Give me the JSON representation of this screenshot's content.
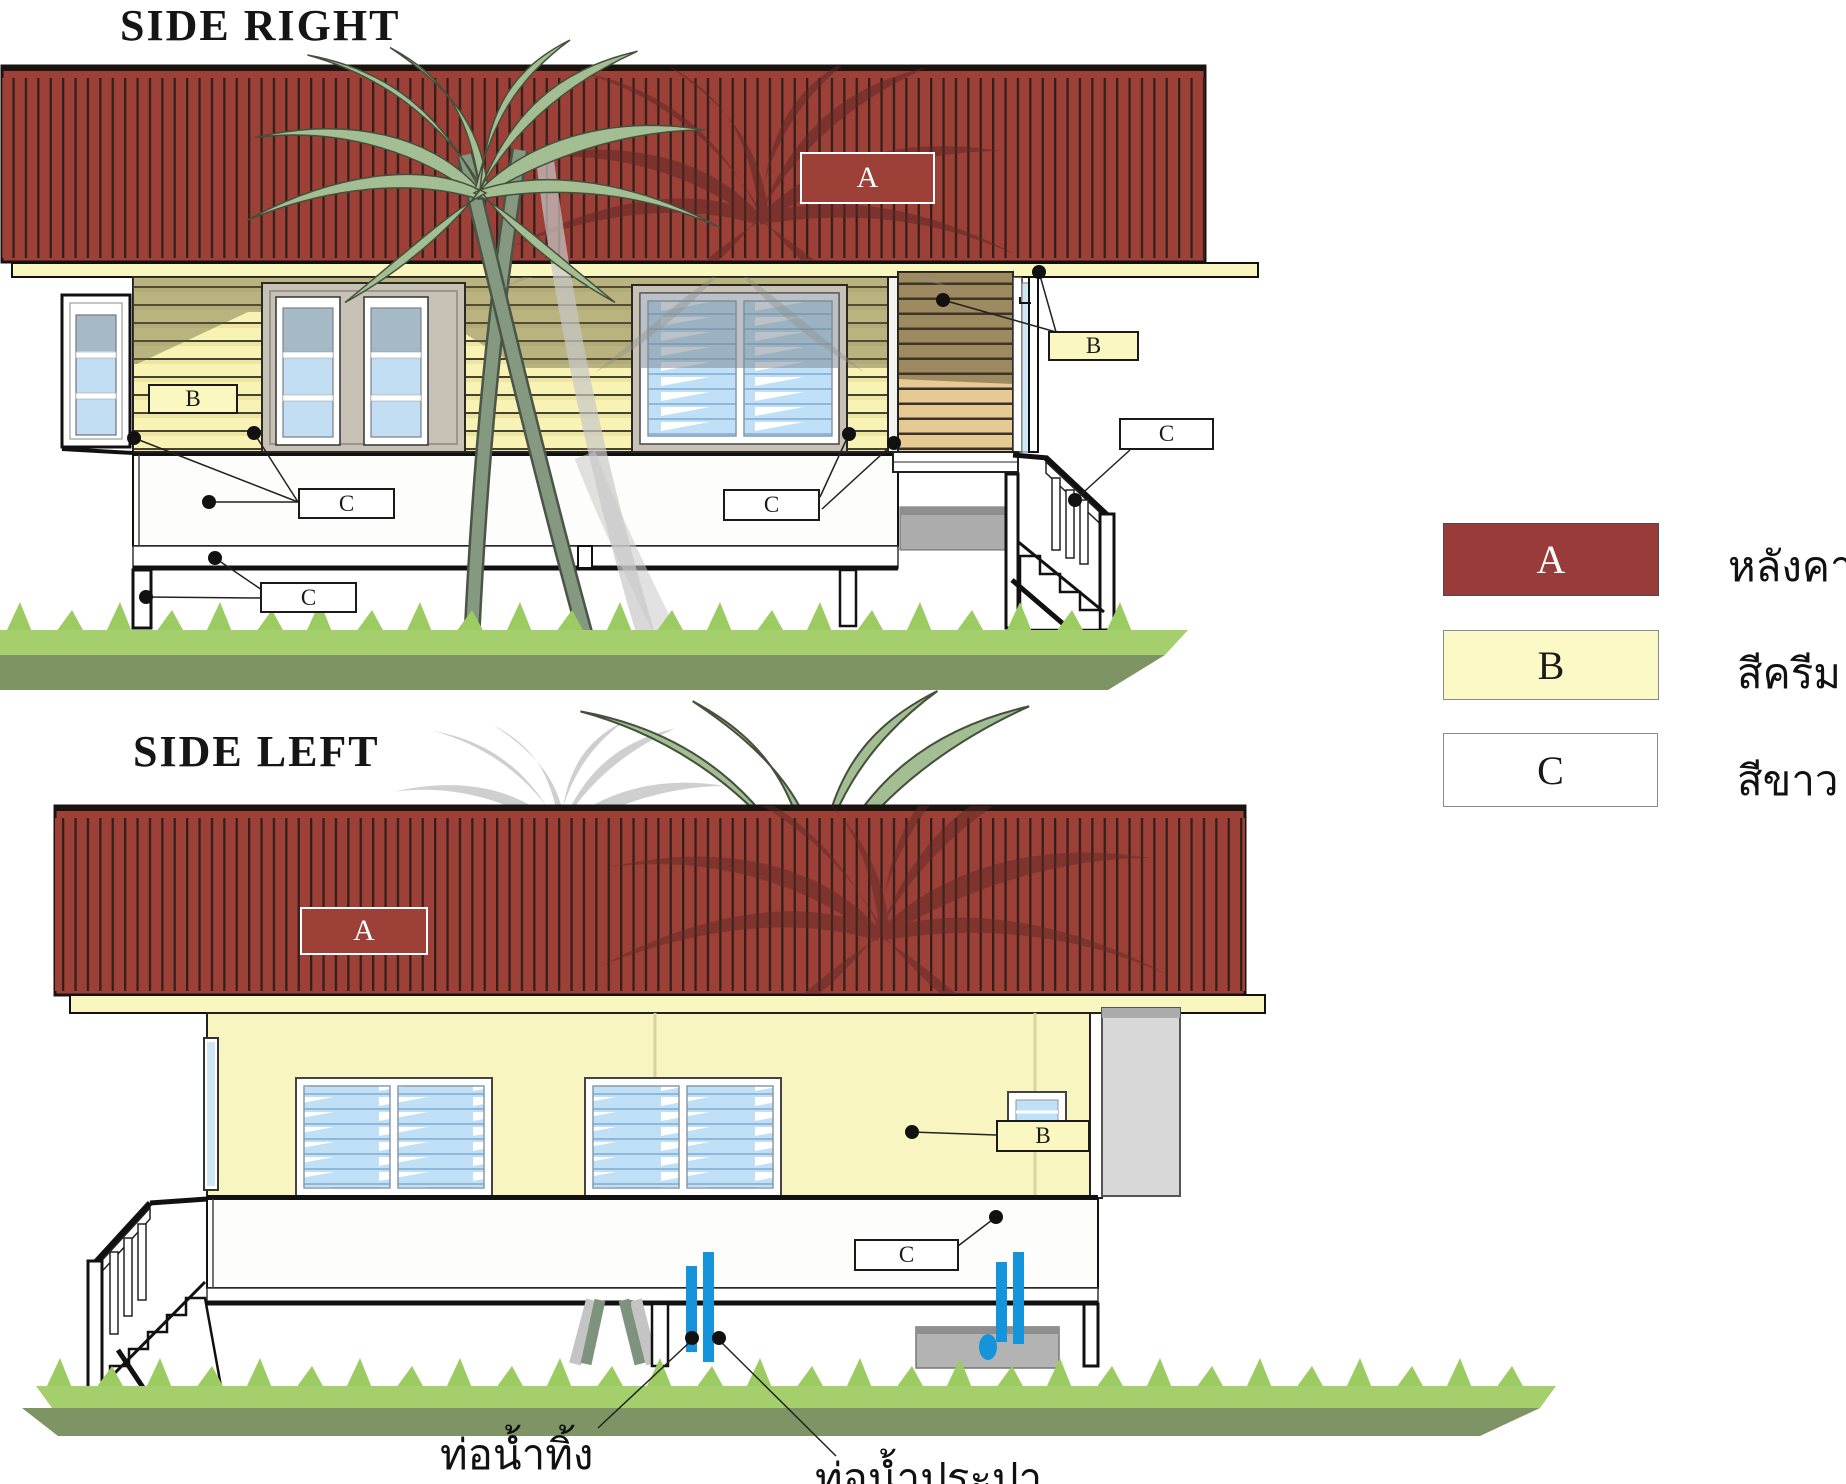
{
  "titles": {
    "right": "SIDE RIGHT",
    "left": "SIDE LEFT"
  },
  "markers": {
    "right_a": "A",
    "right_b1": "B",
    "right_b2": "B",
    "right_c1": "C",
    "right_c2": "C",
    "right_c3": "C",
    "right_c4": "C",
    "left_a": "A",
    "left_b": "B",
    "left_c": "C"
  },
  "legend": {
    "items": [
      {
        "letter": "A",
        "label": "หลังคา",
        "color": "#993B38"
      },
      {
        "letter": "B",
        "label": "สีครีม",
        "color": "#FBF9C6"
      },
      {
        "letter": "C",
        "label": "สีขาว",
        "color": "#FFFFFF"
      }
    ]
  },
  "annotations": {
    "drain_pipe": "ท่อน้ำทิ้ง",
    "water_supply_pipe": "ท่อน้ำประปา"
  },
  "colors": {
    "roof_red": "#9C4038",
    "cream": "#F8F4B8",
    "white": "#FFFFFF",
    "pipe_blue": "#1593DB",
    "grass_light": "#A5CE6C",
    "grass_dark": "#7E9465"
  }
}
